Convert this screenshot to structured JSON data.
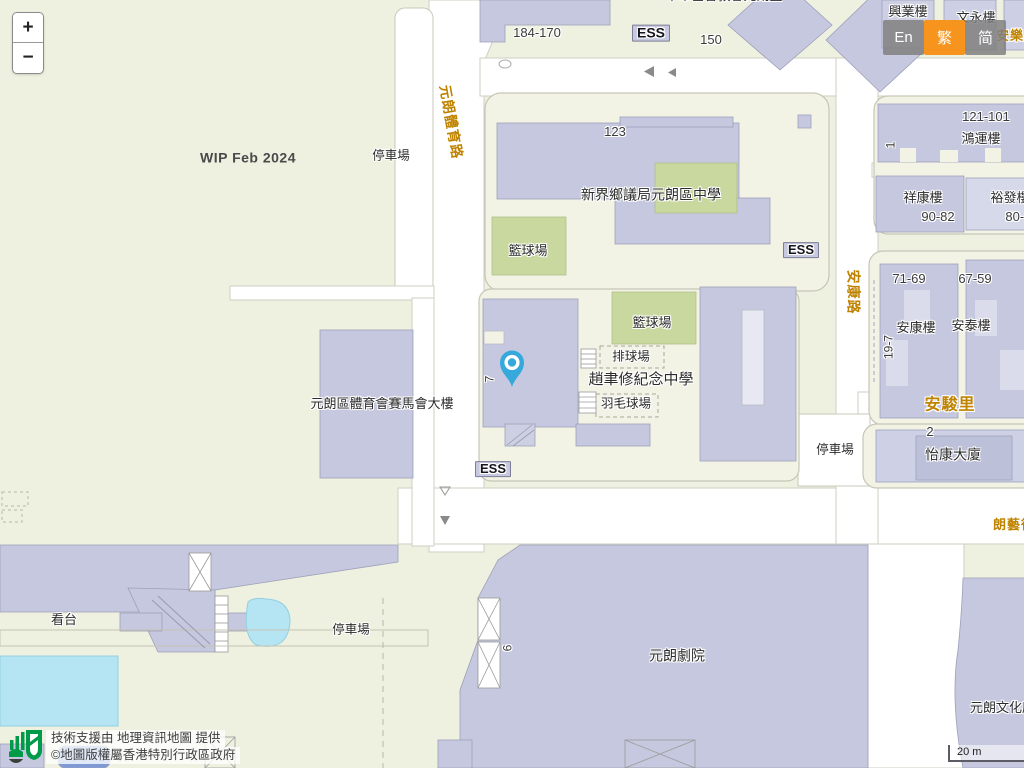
{
  "controls": {
    "zoom_in": "+",
    "zoom_out": "−"
  },
  "language": {
    "active_color": "#f7941d",
    "options": [
      {
        "label": "En",
        "active": false
      },
      {
        "label": "繁",
        "active": true
      },
      {
        "label": "简",
        "active": false
      }
    ]
  },
  "attribution": {
    "line1": "技術支援由 地理資訊地圖 提供",
    "line2": "©地圖版權屬香港特別行政區政府"
  },
  "scale_bar": {
    "label": "20 m"
  },
  "marker": {
    "color": "#35a8dc"
  },
  "map": {
    "labels": [
      {
        "name": "label-range-184-170",
        "text": "184-170",
        "x": 537,
        "y": 33,
        "kind": "number",
        "size": 13
      },
      {
        "name": "label-ess-north",
        "text": "ESS",
        "x": 651,
        "y": 33,
        "kind": "ess",
        "size": 14
      },
      {
        "name": "label-range-150",
        "text": "150",
        "x": 711,
        "y": 40,
        "kind": "number",
        "size": 13
      },
      {
        "name": "label-hing-yip-house",
        "text": "興業樓",
        "x": 908,
        "y": 12,
        "kind": "place",
        "size": 13
      },
      {
        "name": "label-man-wing-house",
        "text": "文永樓",
        "x": 976,
        "y": 18,
        "kind": "place",
        "size": 13
      },
      {
        "name": "label-on-lok-road",
        "text": "安樂路",
        "x": 1017,
        "y": 36,
        "kind": "road",
        "size": 13
      },
      {
        "name": "label-clipped-top",
        "text": "中華基督教會元朗堂",
        "x": 724,
        "y": -4,
        "kind": "place",
        "size": 13
      },
      {
        "name": "label-number-123",
        "text": "123",
        "x": 615,
        "y": 132,
        "kind": "number",
        "size": 13
      },
      {
        "name": "label-nthyk-school",
        "text": "新界鄉議局元朗區中學",
        "x": 651,
        "y": 195,
        "kind": "place",
        "size": 14
      },
      {
        "name": "label-basketball-court-north",
        "text": "籃球場",
        "x": 528,
        "y": 251,
        "kind": "place",
        "size": 13
      },
      {
        "name": "label-ess-east",
        "text": "ESS",
        "x": 801,
        "y": 250,
        "kind": "ess",
        "size": 13
      },
      {
        "name": "label-range-121-101",
        "text": "121-101",
        "x": 986,
        "y": 117,
        "kind": "number",
        "size": 13
      },
      {
        "name": "label-hung-wan-house",
        "text": "鴻運樓",
        "x": 981,
        "y": 139,
        "kind": "place",
        "size": 13
      },
      {
        "name": "label-number-1",
        "text": "1",
        "x": 891,
        "y": 145,
        "kind": "number",
        "size": 12,
        "rot": -90
      },
      {
        "name": "label-cheung-hong-house",
        "text": "祥康樓",
        "x": 923,
        "y": 198,
        "kind": "place",
        "size": 13
      },
      {
        "name": "label-yu-fat-house",
        "text": "裕發樓",
        "x": 1010,
        "y": 198,
        "kind": "place",
        "size": 13
      },
      {
        "name": "label-range-90-82",
        "text": "90-82",
        "x": 938,
        "y": 217,
        "kind": "number",
        "size": 13
      },
      {
        "name": "label-range-80-62",
        "text": "80-62",
        "x": 1022,
        "y": 217,
        "kind": "number",
        "size": 13
      },
      {
        "name": "label-car-park-north",
        "text": "停車場",
        "x": 391,
        "y": 156,
        "kind": "place",
        "size": 12.5
      },
      {
        "name": "label-tai-yuk-road",
        "text": "元朗體育路",
        "x": 451,
        "y": 122,
        "kind": "road",
        "size": 14,
        "rot": 80
      },
      {
        "name": "label-wip",
        "text": "WIP Feb 2024",
        "x": 248,
        "y": 158,
        "kind": "wip",
        "size": 14
      },
      {
        "name": "label-on-hong-road",
        "text": "安康路",
        "x": 853,
        "y": 292,
        "kind": "road",
        "size": 14,
        "rot": 90
      },
      {
        "name": "label-range-71-69",
        "text": "71-69",
        "x": 909,
        "y": 279,
        "kind": "number",
        "size": 13
      },
      {
        "name": "label-range-67-59",
        "text": "67-59",
        "x": 975,
        "y": 279,
        "kind": "number",
        "size": 13
      },
      {
        "name": "label-on-hong-house",
        "text": "安康樓",
        "x": 916,
        "y": 328,
        "kind": "place",
        "size": 13
      },
      {
        "name": "label-on-tai-house",
        "text": "安泰樓",
        "x": 971,
        "y": 326,
        "kind": "place",
        "size": 13
      },
      {
        "name": "label-range-19-7",
        "text": "19-7",
        "x": 889,
        "y": 347,
        "kind": "number",
        "size": 12,
        "rot": -90
      },
      {
        "name": "label-on-chun-lane",
        "text": "安駿里",
        "x": 950,
        "y": 406,
        "kind": "road",
        "size": 16
      },
      {
        "name": "label-number-2",
        "text": "2",
        "x": 930,
        "y": 432,
        "kind": "number",
        "size": 13
      },
      {
        "name": "label-yi-hong-mansion",
        "text": "怡康大廈",
        "x": 953,
        "y": 455,
        "kind": "place",
        "size": 14
      },
      {
        "name": "label-car-park-east",
        "text": "停車場",
        "x": 835,
        "y": 450,
        "kind": "place",
        "size": 12.5
      },
      {
        "name": "label-long-ngai-path",
        "text": "朗藝徑",
        "x": 1014,
        "y": 525,
        "kind": "road",
        "size": 13
      },
      {
        "name": "label-jockey-club-building",
        "text": "元朗區體育會賽馬會大樓",
        "x": 382,
        "y": 404,
        "kind": "place",
        "size": 13
      },
      {
        "name": "label-basketball-court-south",
        "text": "籃球場",
        "x": 652,
        "y": 323,
        "kind": "place",
        "size": 13
      },
      {
        "name": "label-volleyball-court",
        "text": "排球場",
        "x": 631,
        "y": 357,
        "kind": "place",
        "size": 12.5
      },
      {
        "name": "label-clsmss",
        "text": "趙聿修紀念中學",
        "x": 641,
        "y": 380,
        "kind": "place",
        "size": 15
      },
      {
        "name": "label-badminton-court",
        "text": "羽毛球場",
        "x": 626,
        "y": 404,
        "kind": "place",
        "size": 12.5
      },
      {
        "name": "label-number-7",
        "text": "7",
        "x": 490,
        "y": 379,
        "kind": "number",
        "size": 12,
        "rot": -90
      },
      {
        "name": "label-ess-south",
        "text": "ESS",
        "x": 493,
        "y": 469,
        "kind": "ess",
        "size": 13
      },
      {
        "name": "label-grandstand",
        "text": "看台",
        "x": 64,
        "y": 620,
        "kind": "place",
        "size": 13
      },
      {
        "name": "label-car-park-south",
        "text": "停車場",
        "x": 351,
        "y": 630,
        "kind": "place",
        "size": 12.5
      },
      {
        "name": "label-yuen-long-theatre",
        "text": "元朗劇院",
        "x": 677,
        "y": 656,
        "kind": "place",
        "size": 14
      },
      {
        "name": "label-number-6",
        "text": "6",
        "x": 508,
        "y": 648,
        "kind": "number",
        "size": 12,
        "rot": -90
      },
      {
        "name": "label-cultural-building",
        "text": "元朗文化康樂大樓",
        "x": 1022,
        "y": 708,
        "kind": "place",
        "size": 13
      }
    ]
  }
}
